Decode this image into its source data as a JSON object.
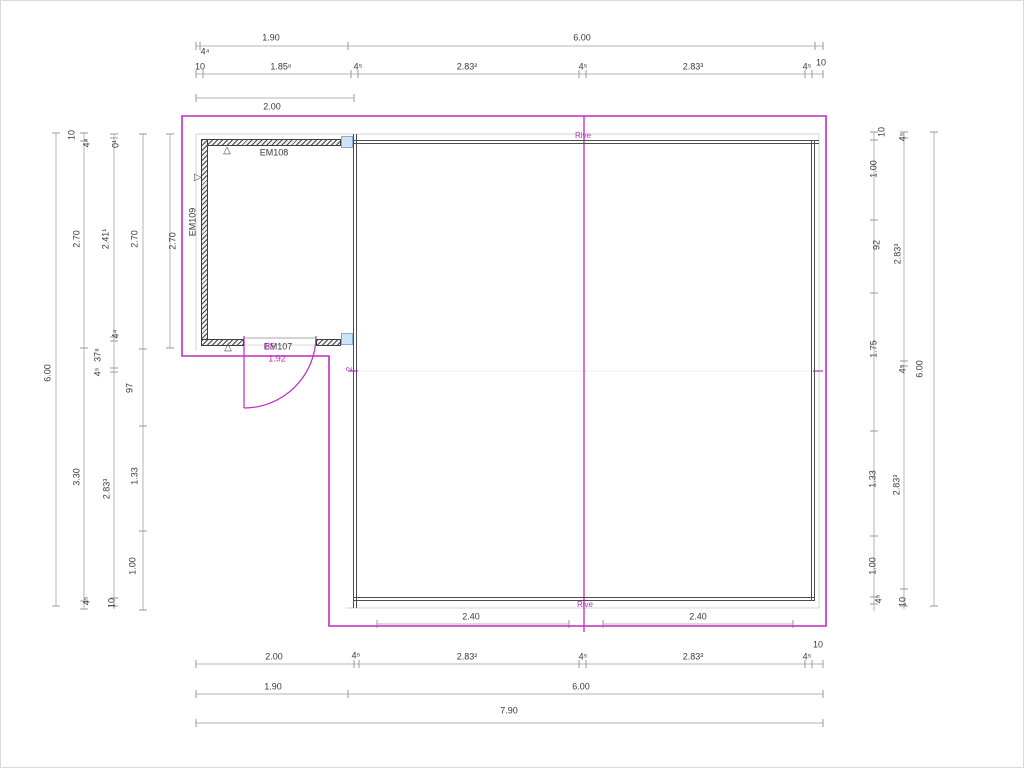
{
  "canvas": {
    "w": 1024,
    "h": 768
  },
  "colors": {
    "dim": "#3a3a3a",
    "magenta": "#c32ac3",
    "dim_line": "#b4b4b4",
    "tick": "#9a9a9a",
    "wall": "#4d4d4d",
    "glyph": "#4a4a4a"
  },
  "dim_h": [
    {
      "name": "dim-top-row-overall",
      "y": 45,
      "x1": 195,
      "x2": 822,
      "t": [
        195,
        199,
        347,
        814,
        822
      ]
    },
    {
      "name": "dim-top-row-detail",
      "y": 73,
      "x1": 195,
      "x2": 822,
      "t": [
        195,
        202,
        350,
        357,
        578,
        585,
        804,
        811,
        822
      ]
    },
    {
      "name": "dim-top-row-200",
      "y": 97,
      "x1": 195,
      "x2": 353,
      "t": [
        195,
        353
      ]
    },
    {
      "name": "dim-bottom-inner-left",
      "y": 623,
      "x1": 376,
      "x2": 568,
      "t": [
        376,
        568
      ]
    },
    {
      "name": "dim-bottom-inner-right",
      "y": 623,
      "x1": 602,
      "x2": 792,
      "t": [
        602,
        792
      ]
    },
    {
      "name": "dim-bottom-row-detail",
      "y": 663,
      "x1": 195,
      "x2": 822,
      "t": [
        195,
        353,
        358,
        578,
        585,
        804,
        811,
        822
      ]
    },
    {
      "name": "dim-bottom-row-overall",
      "y": 693,
      "x1": 195,
      "x2": 822,
      "t": [
        195,
        347,
        822
      ]
    },
    {
      "name": "dim-bottom-row-total",
      "y": 722,
      "x1": 195,
      "x2": 822,
      "t": [
        195,
        822
      ]
    }
  ],
  "dim_v": [
    {
      "name": "dim-left-col-1",
      "x": 55,
      "y1": 132,
      "y2": 605,
      "t": [
        132,
        605
      ]
    },
    {
      "name": "dim-left-col-2",
      "x": 83,
      "y1": 132,
      "y2": 608,
      "t": [
        132,
        140,
        347,
        600,
        608
      ]
    },
    {
      "name": "dim-left-col-3",
      "x": 113,
      "y1": 133,
      "y2": 608,
      "t": [
        133,
        137,
        336,
        340,
        367,
        371,
        597,
        605
      ]
    },
    {
      "name": "dim-left-col-4",
      "x": 142,
      "y1": 133,
      "y2": 609,
      "t": [
        133,
        348,
        425,
        530,
        609
      ]
    },
    {
      "name": "dim-left-col-5",
      "x": 169,
      "y1": 133,
      "y2": 347,
      "t": [
        133,
        347
      ]
    },
    {
      "name": "dim-right-col-1",
      "x": 873,
      "y1": 131,
      "y2": 610,
      "t": [
        131,
        139,
        219,
        292,
        430,
        535,
        596,
        603
      ]
    },
    {
      "name": "dim-right-col-2",
      "x": 903,
      "y1": 131,
      "y2": 608,
      "t": [
        131,
        137,
        360,
        365,
        588,
        605
      ]
    },
    {
      "name": "dim-right-col-3",
      "x": 933,
      "y1": 131,
      "y2": 605,
      "t": [
        131,
        605
      ]
    }
  ],
  "struct_lines": [
    {
      "name": "eave-line-top",
      "x1": 195,
      "y1": 133,
      "x2": 818,
      "y2": 133,
      "c": "#d4d4d4",
      "w": 1
    },
    {
      "name": "eave-line-bottom",
      "x1": 345,
      "y1": 607,
      "x2": 818,
      "y2": 607,
      "c": "#d4d4d4",
      "w": 1
    },
    {
      "name": "eave-line-left",
      "x1": 195,
      "y1": 133,
      "x2": 195,
      "y2": 350,
      "c": "#d4d4d4",
      "w": 1
    },
    {
      "name": "eave-line-right",
      "x1": 818,
      "y1": 133,
      "x2": 818,
      "y2": 607,
      "c": "#d4d4d4",
      "w": 1
    },
    {
      "name": "roof-mid-line",
      "x1": 356,
      "y1": 370,
      "x2": 810,
      "y2": 370,
      "c": "#ececec",
      "w": 1
    },
    {
      "name": "door-opening-top-line",
      "x1": 243,
      "y1": 337,
      "x2": 315,
      "y2": 337,
      "c": "#a8a8a8",
      "w": 1
    },
    {
      "name": "door-opening-bottom-line",
      "x1": 243,
      "y1": 344,
      "x2": 315,
      "y2": 344,
      "c": "#d8d8d8",
      "w": 1
    }
  ],
  "magenta_paths": [
    {
      "name": "roof-outline",
      "d": "M181,115 H825 V625 H328 V355 H181 Z",
      "w": 1.6
    },
    {
      "name": "ridge-line",
      "d": "M583,115 V631",
      "w": 1.3
    },
    {
      "name": "door-leaf",
      "d": "M243,335 V407",
      "w": 1.2
    },
    {
      "name": "door-swing-arc",
      "d": "M315,335 A72 72 0 0 1 243,407",
      "w": 1.2
    },
    {
      "name": "roof-mid-tick-left",
      "d": "M347,370 H357",
      "w": 1.2
    },
    {
      "name": "roof-mid-tick-right",
      "d": "M812,370 H822",
      "w": 1.2
    }
  ],
  "rects": [
    {
      "name": "wall-em108-hatched",
      "cls": "hatch",
      "x": 200,
      "y": 138,
      "w": 140,
      "h": 7
    },
    {
      "name": "wall-em109-hatched",
      "cls": "hatch",
      "x": 200,
      "y": 138,
      "w": 7,
      "h": 207
    },
    {
      "name": "wall-em107-hatched-left",
      "cls": "hatch",
      "x": 200,
      "y": 338,
      "w": 43,
      "h": 7
    },
    {
      "name": "wall-em107-hatched-right",
      "cls": "hatch",
      "x": 315,
      "y": 338,
      "w": 25,
      "h": 7
    },
    {
      "name": "main-wall-top",
      "cls": "wallh",
      "x": 352,
      "y": 139,
      "w": 466,
      "h": 4
    },
    {
      "name": "main-wall-bottom",
      "cls": "wallh",
      "x": 352,
      "y": 596,
      "w": 462,
      "h": 4
    },
    {
      "name": "main-wall-left",
      "cls": "wallv",
      "x": 352,
      "y": 133,
      "w": 4,
      "h": 474
    },
    {
      "name": "main-wall-right",
      "cls": "wallv",
      "x": 810,
      "y": 139,
      "w": 4,
      "h": 461
    },
    {
      "name": "connector-square-top",
      "cls": "bluesq",
      "x": 340,
      "y": 135,
      "w": 12,
      "h": 12
    },
    {
      "name": "connector-square-bottom",
      "cls": "bluesq",
      "x": 340,
      "y": 332,
      "w": 12,
      "h": 12
    }
  ],
  "texts": [
    {
      "name": "dim-top-1-90",
      "text": "1.90",
      "x": 270,
      "y": 37
    },
    {
      "name": "dim-top-6-00",
      "text": "6.00",
      "x": 581,
      "y": 37
    },
    {
      "name": "dim-top-4-4",
      "text": "4⁴",
      "x": 204,
      "y": 51
    },
    {
      "name": "dim-top-10-right",
      "text": "10",
      "x": 820,
      "y": 62
    },
    {
      "name": "dim-top2-10",
      "text": "10",
      "x": 199,
      "y": 66
    },
    {
      "name": "dim-top2-1-85-6",
      "text": "1.85⁶",
      "x": 280,
      "y": 66
    },
    {
      "name": "dim-top2-4-5-a",
      "text": "4⁵",
      "x": 357,
      "y": 66
    },
    {
      "name": "dim-top2-2-83-2",
      "text": "2.83²",
      "x": 466,
      "y": 66
    },
    {
      "name": "dim-top2-4-5-b",
      "text": "4⁵",
      "x": 582,
      "y": 66
    },
    {
      "name": "dim-top2-2-83-3",
      "text": "2.83³",
      "x": 692,
      "y": 66
    },
    {
      "name": "dim-top2-4-5-c",
      "text": "4⁵",
      "x": 806,
      "y": 66
    },
    {
      "name": "dim-top-2-00",
      "text": "2.00",
      "x": 271,
      "y": 106
    },
    {
      "name": "dim-inner-2-40-left",
      "text": "2.40",
      "x": 470,
      "y": 616
    },
    {
      "name": "dim-inner-2-40-right",
      "text": "2.40",
      "x": 697,
      "y": 616
    },
    {
      "name": "rive-label-bottom",
      "text": "Rive",
      "x": 584,
      "y": 604,
      "c": "magenta",
      "s": 8
    },
    {
      "name": "dim-bot1-2-00",
      "text": "2.00",
      "x": 273,
      "y": 656
    },
    {
      "name": "dim-bot1-4-5-a",
      "text": "4⁵",
      "x": 355,
      "y": 655
    },
    {
      "name": "dim-bot1-2-83-2",
      "text": "2.83²",
      "x": 466,
      "y": 656
    },
    {
      "name": "dim-bot1-4-5-b",
      "text": "4⁵",
      "x": 582,
      "y": 656
    },
    {
      "name": "dim-bot1-2-83-3",
      "text": "2.83³",
      "x": 692,
      "y": 656
    },
    {
      "name": "dim-bot1-4-5-c",
      "text": "4⁵",
      "x": 806,
      "y": 656
    },
    {
      "name": "dim-bot-10",
      "text": "10",
      "x": 817,
      "y": 644
    },
    {
      "name": "dim-bot2-1-90",
      "text": "1.90",
      "x": 272,
      "y": 686
    },
    {
      "name": "dim-bot2-6-00",
      "text": "6.00",
      "x": 580,
      "y": 686
    },
    {
      "name": "dim-bot3-7-90",
      "text": "7.90",
      "x": 508,
      "y": 710
    },
    {
      "name": "dim-left-6-00",
      "text": "6.00",
      "x": 47,
      "y": 372,
      "r": 1
    },
    {
      "name": "dim-left2-10",
      "text": "10",
      "x": 71,
      "y": 134,
      "r": 1
    },
    {
      "name": "dim-left2-2-70",
      "text": "2.70",
      "x": 76,
      "y": 238,
      "r": 1
    },
    {
      "name": "dim-left2-3-30",
      "text": "3.30",
      "x": 76,
      "y": 476,
      "r": 1
    },
    {
      "name": "dim-left2-4-5",
      "text": "4⁵",
      "x": 86,
      "y": 600,
      "r": 1
    },
    {
      "name": "dim-left3-4-4-top",
      "text": "4⁴",
      "x": 86,
      "y": 142,
      "r": 1
    },
    {
      "name": "dim-left3-2-41-1",
      "text": "2.41¹",
      "x": 105,
      "y": 238,
      "r": 1
    },
    {
      "name": "dim-left3-4-4-mid",
      "text": "4⁴",
      "x": 115,
      "y": 333,
      "r": 1
    },
    {
      "name": "dim-left3-37-8",
      "text": "37⁸",
      "x": 97,
      "y": 354,
      "r": 1
    },
    {
      "name": "dim-left3-4-5",
      "text": "4⁵",
      "x": 97,
      "y": 371,
      "r": 1
    },
    {
      "name": "dim-left3-2-83-3",
      "text": "2.83³",
      "x": 106,
      "y": 488,
      "r": 1
    },
    {
      "name": "dim-left3-10",
      "text": "10",
      "x": 111,
      "y": 602,
      "r": 1
    },
    {
      "name": "dim-left4-0-1",
      "text": "0¹",
      "x": 115,
      "y": 143,
      "r": 1
    },
    {
      "name": "dim-left4-2-70",
      "text": "2.70",
      "x": 134,
      "y": 238,
      "r": 1
    },
    {
      "name": "dim-left4-97",
      "text": "97",
      "x": 129,
      "y": 387,
      "r": 1
    },
    {
      "name": "dim-left4-1-33",
      "text": "1.33",
      "x": 134,
      "y": 475,
      "r": 1
    },
    {
      "name": "dim-left4-1-00",
      "text": "1.00",
      "x": 132,
      "y": 565,
      "r": 1
    },
    {
      "name": "dim-left5-2-70",
      "text": "2.70",
      "x": 172,
      "y": 240,
      "r": 1
    },
    {
      "name": "dim-right1-10",
      "text": "10",
      "x": 881,
      "y": 131,
      "r": 1
    },
    {
      "name": "dim-right1-1-00-top",
      "text": "1.00",
      "x": 873,
      "y": 168,
      "r": 1
    },
    {
      "name": "dim-right1-92",
      "text": "92",
      "x": 876,
      "y": 244,
      "r": 1
    },
    {
      "name": "dim-right1-1-75",
      "text": "1.75",
      "x": 873,
      "y": 348,
      "r": 1
    },
    {
      "name": "dim-right1-1-33",
      "text": "1.33",
      "x": 872,
      "y": 478,
      "r": 1
    },
    {
      "name": "dim-right1-1-00-bot",
      "text": "1.00",
      "x": 872,
      "y": 565,
      "r": 1
    },
    {
      "name": "dim-right1-4-5",
      "text": "4⁵",
      "x": 878,
      "y": 598,
      "r": 1
    },
    {
      "name": "dim-right2-4-5-top",
      "text": "4⁵",
      "x": 902,
      "y": 136,
      "r": 1
    },
    {
      "name": "dim-right2-2-83-3-top",
      "text": "2.83³",
      "x": 897,
      "y": 253,
      "r": 1
    },
    {
      "name": "dim-right2-4-5-mid",
      "text": "4⁵",
      "x": 902,
      "y": 368,
      "r": 1
    },
    {
      "name": "dim-right2-2-83-3-bot",
      "text": "2.83³",
      "x": 896,
      "y": 484,
      "r": 1
    },
    {
      "name": "dim-right2-10",
      "text": "10",
      "x": 902,
      "y": 601,
      "r": 1
    },
    {
      "name": "dim-right3-6-00",
      "text": "6.00",
      "x": 919,
      "y": 368,
      "r": 1
    },
    {
      "name": "wall-label-em108",
      "text": "EM108",
      "x": 273,
      "y": 152
    },
    {
      "name": "wall-label-em109",
      "text": "EM109",
      "x": 192,
      "y": 221,
      "r": 1
    },
    {
      "name": "wall-label-em107",
      "text": "EM107",
      "x": 277,
      "y": 346
    },
    {
      "name": "door-width-label",
      "text": "85",
      "x": 269,
      "y": 346,
      "c": "magenta"
    },
    {
      "name": "door-dim-1-92",
      "text": "1.92",
      "x": 276,
      "y": 358,
      "c": "magenta"
    },
    {
      "name": "rive-label-top",
      "text": "Rive",
      "x": 582,
      "y": 135,
      "c": "magenta",
      "s": 8
    },
    {
      "name": "roof-mid-label-2",
      "text": "2",
      "x": 349,
      "y": 368,
      "r": 1,
      "c": "magenta",
      "s": 8
    },
    {
      "name": "marker-triangle-top",
      "text": "△",
      "x": 226,
      "y": 150,
      "c": "glyph",
      "s": 10
    },
    {
      "name": "marker-triangle-left",
      "text": "▷",
      "x": 197,
      "y": 177,
      "c": "glyph",
      "s": 10
    },
    {
      "name": "marker-triangle-bottom",
      "text": "△",
      "x": 227,
      "y": 347,
      "c": "glyph",
      "s": 10
    }
  ]
}
